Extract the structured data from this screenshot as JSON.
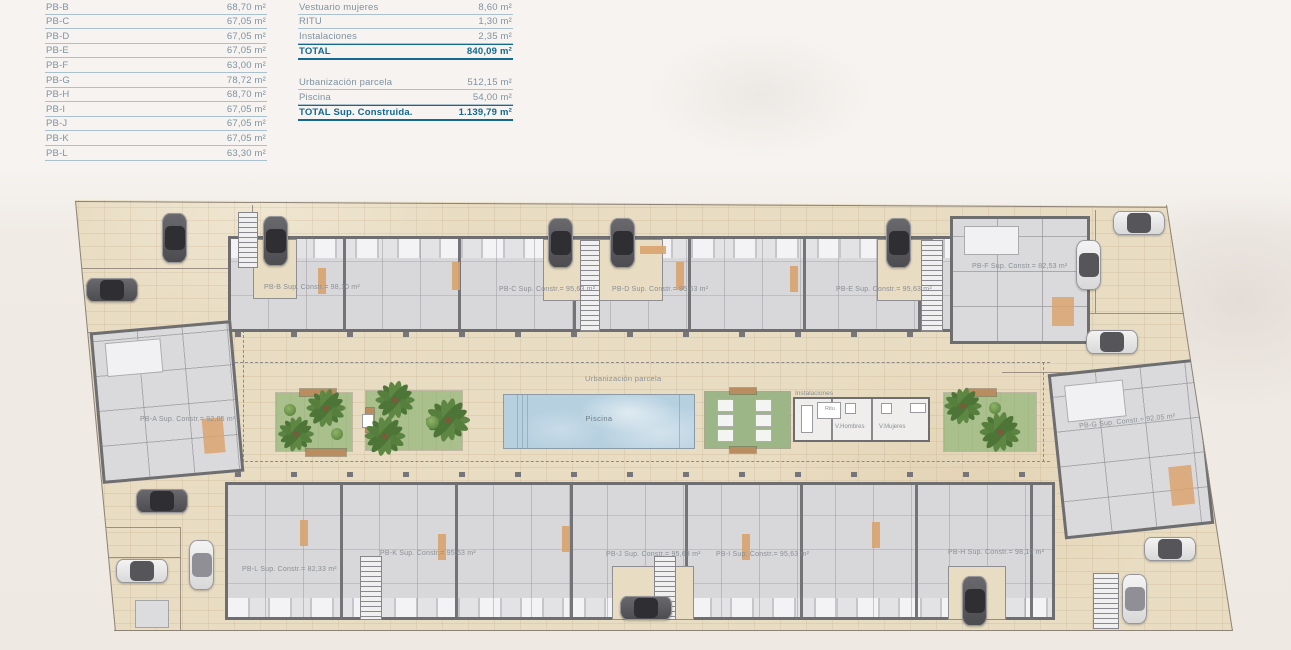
{
  "sheet_title": "Planta baja — superficies",
  "tables": {
    "unit_areas": {
      "rows": [
        {
          "label": "PB-B",
          "value": "68,70 m²"
        },
        {
          "label": "PB-C",
          "value": "67,05 m²"
        },
        {
          "label": "PB-D",
          "value": "67,05 m²"
        },
        {
          "label": "PB-E",
          "value": "67,05 m²"
        },
        {
          "label": "PB-F",
          "value": "63,00 m²"
        },
        {
          "label": "PB-G",
          "value": "78,72 m²"
        },
        {
          "label": "PB-H",
          "value": "68,70 m²"
        },
        {
          "label": "PB-I",
          "value": "67,05 m²"
        },
        {
          "label": "PB-J",
          "value": "67,05 m²"
        },
        {
          "label": "PB-K",
          "value": "67,05 m²"
        },
        {
          "label": "PB-L",
          "value": "63,30 m²"
        }
      ]
    },
    "summary": {
      "group1": [
        {
          "label": "Vestuario mujeres",
          "value": "8,60 m²"
        },
        {
          "label": "RITU",
          "value": "1,30 m²"
        },
        {
          "label": "Instalaciones",
          "value": "2,35 m²"
        },
        {
          "label": "TOTAL",
          "value": "840,09 m²",
          "cls": "total"
        }
      ],
      "group2": [
        {
          "label": "Urbanización parcela",
          "value": "512,15 m²"
        },
        {
          "label": "Piscina",
          "value": "54,00 m²"
        },
        {
          "label": "TOTAL Sup. Construida.",
          "value": "1.139,79 m²",
          "cls": "total"
        }
      ]
    }
  },
  "plan": {
    "units": [
      {
        "id": "PB-A",
        "label": "PB-A Sup. Constr.= 92,05 m²"
      },
      {
        "id": "PB-B",
        "label": "PB-B Sup. Constr.= 98,10 m²"
      },
      {
        "id": "PB-C",
        "label": "PB-C Sup. Constr.= 95,63 m²"
      },
      {
        "id": "PB-D",
        "label": "PB-D Sup. Constr.= 95,63 m²"
      },
      {
        "id": "PB-E",
        "label": "PB-E Sup. Constr.= 95,63 m²"
      },
      {
        "id": "PB-F",
        "label": "PB-F Sup. Constr.= 82,53 m²"
      },
      {
        "id": "PB-G",
        "label": "PB-G Sup. Constr.= 92,05 m²"
      },
      {
        "id": "PB-H",
        "label": "PB-H Sup. Constr.= 98,10 m²"
      },
      {
        "id": "PB-I",
        "label": "PB-I Sup. Constr.= 95,63 m²"
      },
      {
        "id": "PB-J",
        "label": "PB-J Sup. Constr.= 95,63 m²"
      },
      {
        "id": "PB-K",
        "label": "PB-K Sup. Constr.= 95,63 m²"
      },
      {
        "id": "PB-L",
        "label": "PB-L Sup. Constr.= 82,33 m²"
      }
    ],
    "amenities": {
      "urbanizacion": "Urbanización parcela",
      "piscina": "Piscina",
      "instalaciones": "Instalaciones",
      "ritu": "Ritu",
      "v_hombres": "V.Hombres",
      "v_mujeres": "V.Mujeres"
    }
  },
  "colors": {
    "table_text": "#7e93a0",
    "table_total": "#15688f",
    "separator": "#a9c0cd",
    "paving": "#e8dcc2",
    "building_wall": "#6e6e71",
    "room_fill": "#d8d8db",
    "accent_orange": "#d9a36e",
    "garden_green": "#a9bf8c",
    "palm_green": "#567f3e",
    "pool_blue": "#b6d0e0",
    "pergola_green": "#9db687"
  }
}
